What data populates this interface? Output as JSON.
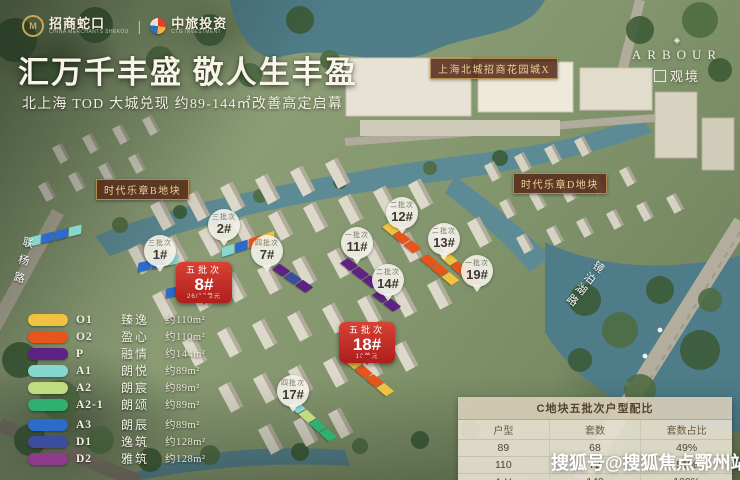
{
  "branding": {
    "logo_cm": "招商蛇口",
    "logo_cm_sub": "CHINA MERCHANTS SHEKOU",
    "divider": "|",
    "logo_ctg": "中旅投资",
    "logo_ctg_sub": "CTG INVESTMENT"
  },
  "header": {
    "title": "汇万千丰盛 敬人生丰盈",
    "subtitle": "北上海 TOD 大城兑现 约89-144㎡改善高定启幕"
  },
  "project_mark": {
    "en": "ARBOUR",
    "cn": "观境"
  },
  "map_labels": {
    "mall": "上海北城招商花园城X",
    "plot_left": "时代乐章B地块",
    "plot_right": "时代乐章D地块",
    "road_left": "联杨路",
    "road_right": "镜泊湖路"
  },
  "markers": {
    "balloons": [
      {
        "batch": "三批次",
        "num": "1#",
        "x": 160,
        "y": 251
      },
      {
        "batch": "三批次",
        "num": "2#",
        "x": 224,
        "y": 225
      },
      {
        "batch": "四批次",
        "num": "7#",
        "x": 267,
        "y": 251
      },
      {
        "batch": "一批次",
        "num": "11#",
        "x": 357,
        "y": 243
      },
      {
        "batch": "二批次",
        "num": "12#",
        "x": 402,
        "y": 213
      },
      {
        "batch": "二批次",
        "num": "13#",
        "x": 444,
        "y": 239
      },
      {
        "batch": "二批次",
        "num": "14#",
        "x": 388,
        "y": 280
      },
      {
        "batch": "一批次",
        "num": "19#",
        "x": 477,
        "y": 271
      },
      {
        "batch": "四批次",
        "num": "17#",
        "x": 293,
        "y": 391
      }
    ],
    "pins": [
      {
        "batch": "五批次",
        "num": "8#",
        "sub": "26/27单元",
        "x": 204,
        "y": 262
      },
      {
        "batch": "五批次",
        "num": "18#",
        "sub": "10单元",
        "x": 367,
        "y": 322
      }
    ]
  },
  "legend": {
    "items": [
      {
        "code": "O1",
        "name": "臻逸",
        "area": "约110m²",
        "color": "#F0C23F"
      },
      {
        "code": "O2",
        "name": "盈心",
        "area": "约110m²",
        "color": "#E8551C"
      },
      {
        "code": "P",
        "name": "融情",
        "area": "约144m²",
        "color": "#5E2284"
      },
      {
        "code": "A1",
        "name": "朗悦",
        "area": "约89m²",
        "color": "#86D8CF"
      },
      {
        "code": "A2",
        "name": "朗宸",
        "area": "约89m²",
        "color": "#BFDC7E"
      },
      {
        "code": "A2-1",
        "name": "朗颂",
        "area": "约89m²",
        "color": "#2FAF70"
      },
      {
        "code": "A3",
        "name": "朗辰",
        "area": "约89m²",
        "color": "#2B6BC9"
      },
      {
        "code": "D1",
        "name": "逸筑",
        "area": "约128m²",
        "color": "#3C4C9E"
      },
      {
        "code": "D2",
        "name": "雅筑",
        "area": "约128m²",
        "color": "#8F3A8C"
      }
    ]
  },
  "table": {
    "title": "C地块五批次户型配比",
    "headers": [
      "户型",
      "套数",
      "套数占比"
    ],
    "rows": [
      [
        "89",
        "68",
        "49%"
      ],
      [
        "110",
        "72",
        "51%"
      ],
      [
        "合计",
        "140",
        "100%"
      ]
    ]
  },
  "watermark": "搜狐号@搜狐焦点鄂州站",
  "chains": [
    {
      "x": 28,
      "y": 238,
      "rot": -14,
      "colors": [
        "#86D8CF",
        "#2B6BC9",
        "#2B6BC9",
        "#86D8CF"
      ]
    },
    {
      "x": 138,
      "y": 263,
      "rot": -12,
      "colors": [
        "#2B6BC9",
        "#2B6BC9",
        "#86D8CF"
      ]
    },
    {
      "x": 166,
      "y": 289,
      "rot": -12,
      "colors": [
        "#2B6BC9",
        "#86D8CF"
      ]
    },
    {
      "x": 222,
      "y": 248,
      "rot": -18,
      "colors": [
        "#86D8CF",
        "#2B6BC9",
        "#E8551C",
        "#F0C23F"
      ]
    },
    {
      "x": 276,
      "y": 262,
      "rot": 35,
      "colors": [
        "#5E2284",
        "#3C4C9E",
        "#5E2284"
      ]
    },
    {
      "x": 344,
      "y": 256,
      "rot": 38,
      "colors": [
        "#5E2284",
        "#5E2284",
        "#5E2284"
      ]
    },
    {
      "x": 386,
      "y": 220,
      "rot": 40,
      "colors": [
        "#F0C23F",
        "#E8551C",
        "#E8551C"
      ]
    },
    {
      "x": 424,
      "y": 252,
      "rot": 40,
      "colors": [
        "#E8551C",
        "#E8551C",
        "#F0C23F"
      ]
    },
    {
      "x": 376,
      "y": 288,
      "rot": 38,
      "colors": [
        "#5E2284",
        "#5E2284"
      ]
    },
    {
      "x": 444,
      "y": 250,
      "rot": 42,
      "colors": [
        "#F0C23F",
        "#E8551C",
        "#E8551C"
      ]
    },
    {
      "x": 348,
      "y": 354,
      "rot": 40,
      "colors": [
        "#F0C23F",
        "#E8551C",
        "#E8551C",
        "#F0C23F"
      ]
    },
    {
      "x": 292,
      "y": 398,
      "rot": 42,
      "colors": [
        "#86D8CF",
        "#BFDC7E",
        "#2FAF70",
        "#2FAF70"
      ]
    }
  ]
}
